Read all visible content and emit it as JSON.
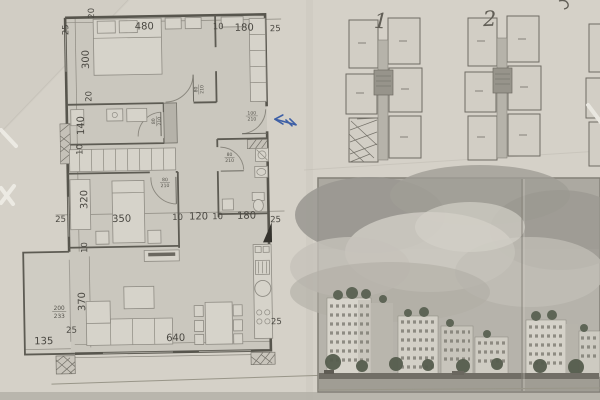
{
  "plan": {
    "dims": {
      "top_20": "20",
      "top_480": "480",
      "top_10": "10",
      "top_180": "180",
      "top_25": "25",
      "left_25": "25",
      "left_300": "300",
      "left_20": "20",
      "left_140": "140",
      "left_10": "10",
      "left_320": "320",
      "left_25_mid": "25",
      "left_10_low": "10",
      "mid_350": "350",
      "mid_10a": "10",
      "mid_120": "120",
      "mid_10b": "10",
      "mid_180": "180",
      "mid_25": "25",
      "low_370": "370",
      "low_200": "200",
      "low_233": "233",
      "low_25": "25",
      "low_135": "135",
      "low_640": "640",
      "low_25_right": "25"
    },
    "doors": {
      "bedroom1": {
        "w": "80",
        "h": "210"
      },
      "bath1": {
        "w": "80",
        "h": "210"
      },
      "entry": {
        "w": "100",
        "h": "210"
      },
      "bath2": {
        "w": "80",
        "h": "210"
      },
      "bedroom2": {
        "w": "80",
        "h": "210"
      }
    }
  },
  "key_plans": {
    "plan1_label": "1",
    "plan2_label": "2"
  },
  "colors": {
    "pen_blue": "#3d5fa6",
    "paper": "#d5d1c8",
    "ink": "#4a4842"
  }
}
